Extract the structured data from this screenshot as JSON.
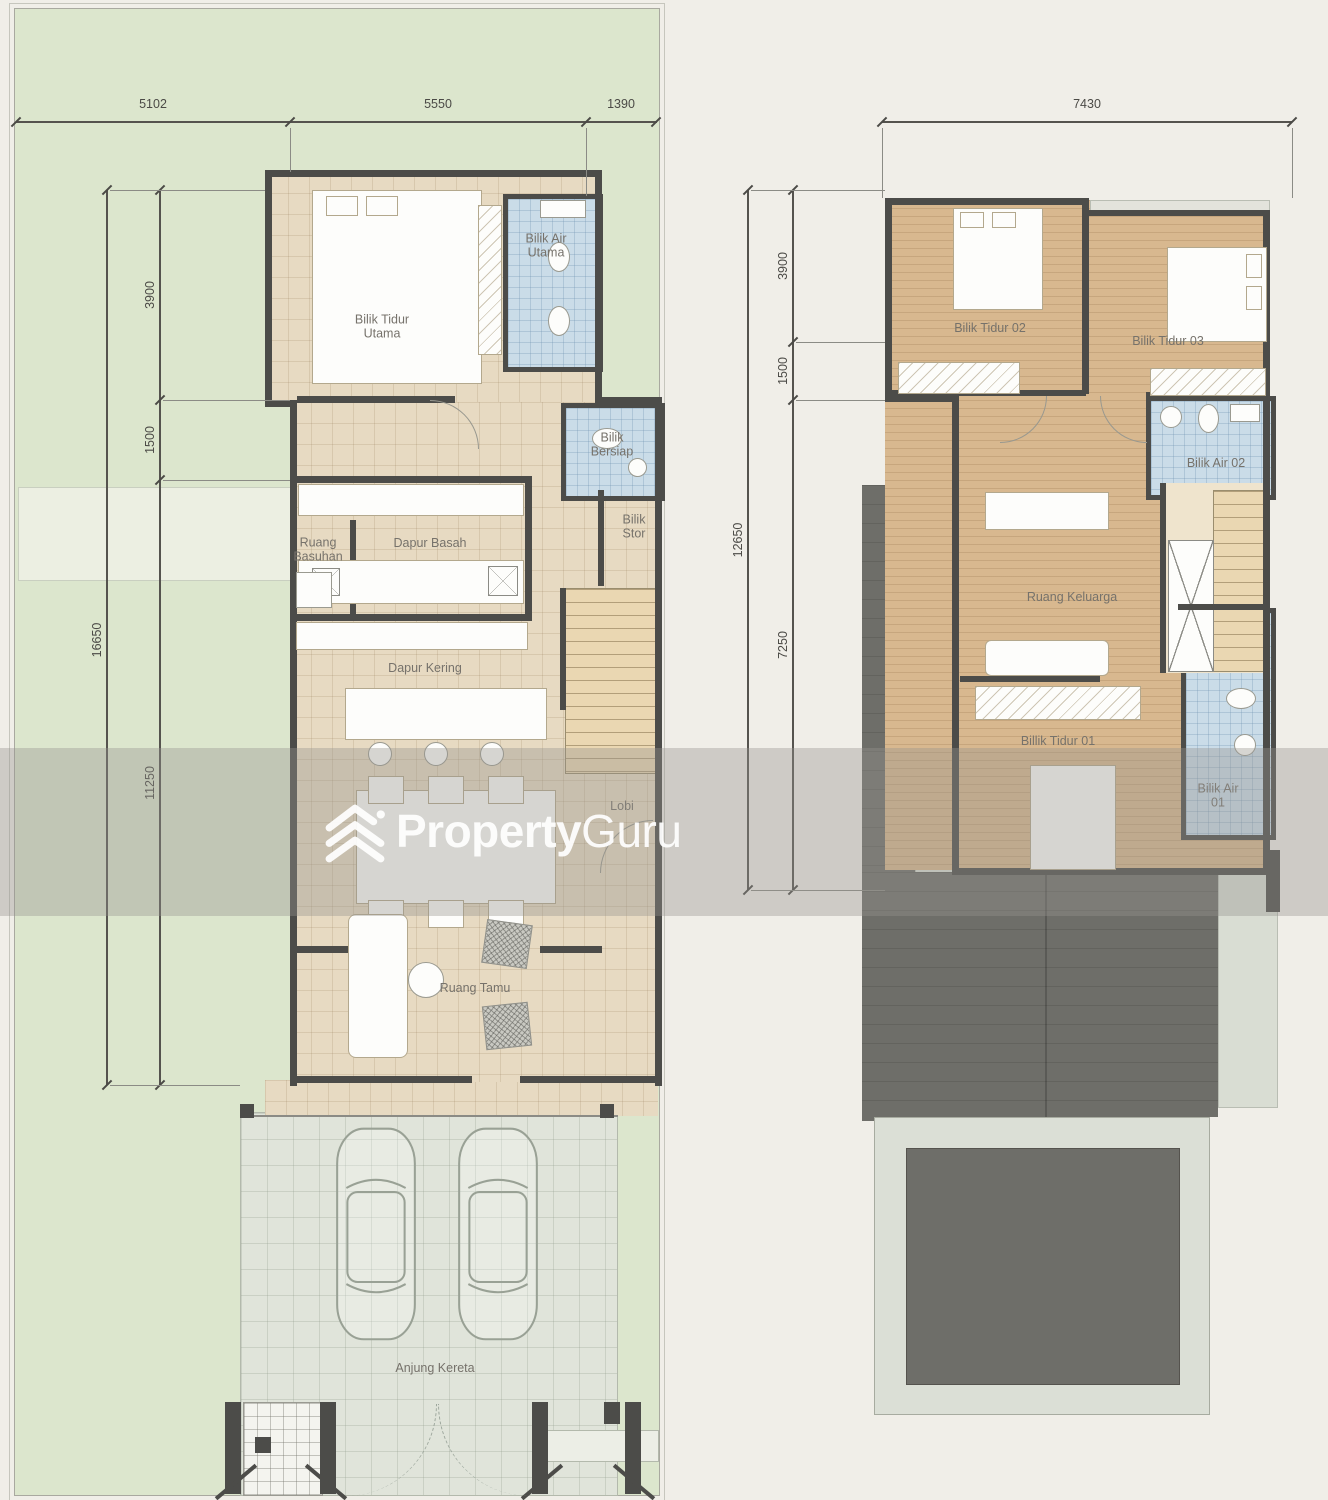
{
  "title": "Two-storey house floor plans",
  "watermark": {
    "brand_bold": "Property",
    "brand_light": "Guru"
  },
  "plans": {
    "ground": {
      "dims": {
        "top": [
          "5102",
          "5550",
          "1390"
        ],
        "left_outer": "16650",
        "left_segments": [
          "3900",
          "1500",
          "11250"
        ]
      },
      "rooms": {
        "bilik_tidur_utama": "Bilik Tidur\nUtama",
        "bilik_air_utama": "Bilik Air\nUtama",
        "bilik_bersiap": "Bilik\nBersiap",
        "bilik_stor": "Bilik\nStor",
        "ruang_basuhan": "Ruang\nBasuhan",
        "dapur_basah": "Dapur Basah",
        "dapur_kering": "Dapur Kering",
        "lobi": "Lobi",
        "ruang_tamu": "Ruang Tamu",
        "anjung_kereta": "Anjung Kereta"
      }
    },
    "first": {
      "dims": {
        "top": [
          "7430"
        ],
        "left_outer": "12650",
        "left_segments": [
          "3900",
          "1500",
          "7250"
        ]
      },
      "rooms": {
        "bilik_tidur_02": "Bilik Tidur 02",
        "bilik_tidur_03": "Bilik Tidur 03",
        "bilik_air_02": "Bilik Air 02",
        "ruang_keluarga": "Ruang Keluarga",
        "billik_tidur_01": "Billik Tidur 01",
        "bilik_air_01": "Bilik Air\n01"
      }
    }
  },
  "colors": {
    "paper": "#f0eee8",
    "grass": "#dce6cd",
    "wall": "#4c4c49",
    "tile": "#e7dac2",
    "wood": "#d8b88f",
    "bathroom": "#cadce8",
    "roof_dark": "#6e6e69",
    "roof_light": "#d9ddd3",
    "concrete": "#e0e4da",
    "watermark_white": "#ffffff"
  }
}
